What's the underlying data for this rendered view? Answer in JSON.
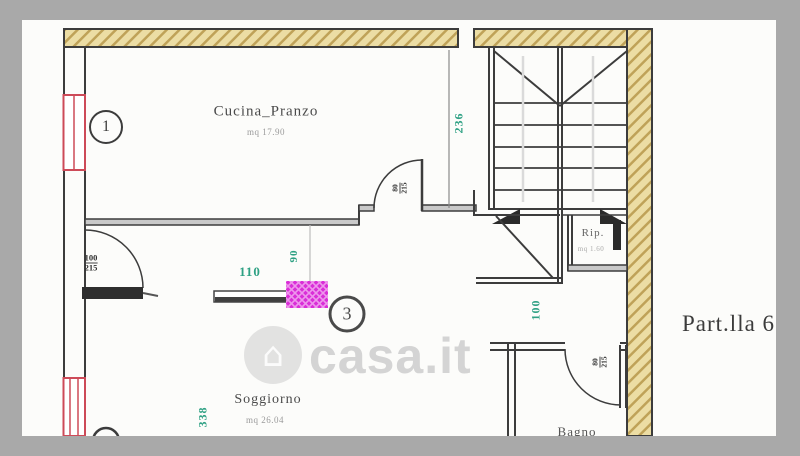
{
  "watermark": {
    "text": "casa.it",
    "icon": "house-icon"
  },
  "parcel_label": "Part.lla 6",
  "rooms": {
    "cucina": {
      "name": "Cucina_Pranzo",
      "area": "mq 17.90"
    },
    "soggiorno": {
      "name": "Soggiorno",
      "area": "mq 26.04"
    },
    "rip": {
      "name": "Rip.",
      "area": "mq 1.60"
    },
    "bagno": {
      "name": "Bagno"
    }
  },
  "markers": {
    "one": "1",
    "three": "3"
  },
  "dimensions": {
    "d236": "236",
    "d110": "110",
    "d90": "90",
    "d100": "100",
    "d338": "338"
  },
  "doors": {
    "kitchen": {
      "width": "80",
      "height": "215"
    },
    "living": {
      "width": "100",
      "height": "215"
    },
    "bathroom": {
      "width": "80",
      "height": "215"
    }
  },
  "colors": {
    "dimension_green": "#2fa184",
    "window_red": "#cd4a58",
    "highlight_magenta": "#da2ed8",
    "wall_hatch_tan": "#ecdda4",
    "frame_gray": "#a9a9a9"
  }
}
